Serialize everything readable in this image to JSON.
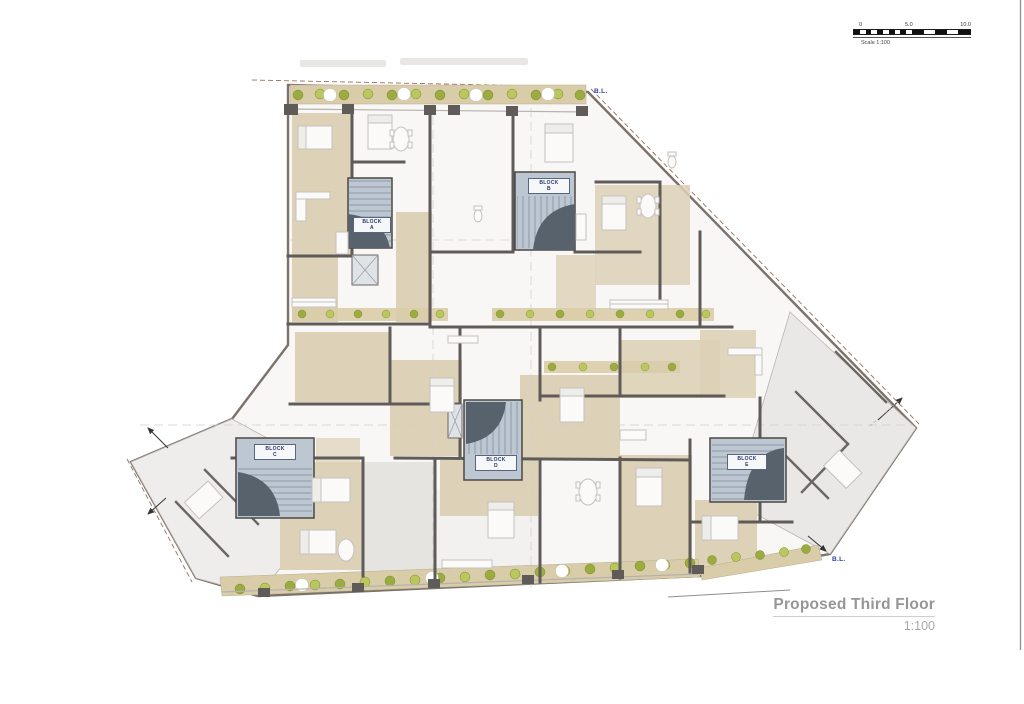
{
  "sheet": {
    "title": "Proposed Third Floor",
    "scale_label": "1:100"
  },
  "scale_bar": {
    "start": "0",
    "mid": "5.0",
    "end": "10.0",
    "caption": "Scale 1:100"
  },
  "blocks": [
    {
      "name": "BLOCK",
      "letter": "A"
    },
    {
      "name": "BLOCK",
      "letter": "B"
    },
    {
      "name": "BLOCK",
      "letter": "C"
    },
    {
      "name": "BLOCK",
      "letter": "D"
    },
    {
      "name": "BLOCK",
      "letter": "E"
    }
  ],
  "boundary": {
    "top": "B.L.",
    "bottom": "B.L."
  },
  "colors": {
    "wall": "#5f5b58",
    "room_tan": "#ddd1b7",
    "wing_gray": "#ebeae7",
    "stair_fill": "#bdc7d1",
    "stair_arc": "#57626d",
    "planter_tan": "#d9cca9",
    "plant_green": "#9aab3f",
    "plant_light_green": "#bac75e",
    "boundary_blue": "#2f3fa5",
    "title_gray": "#969696"
  }
}
